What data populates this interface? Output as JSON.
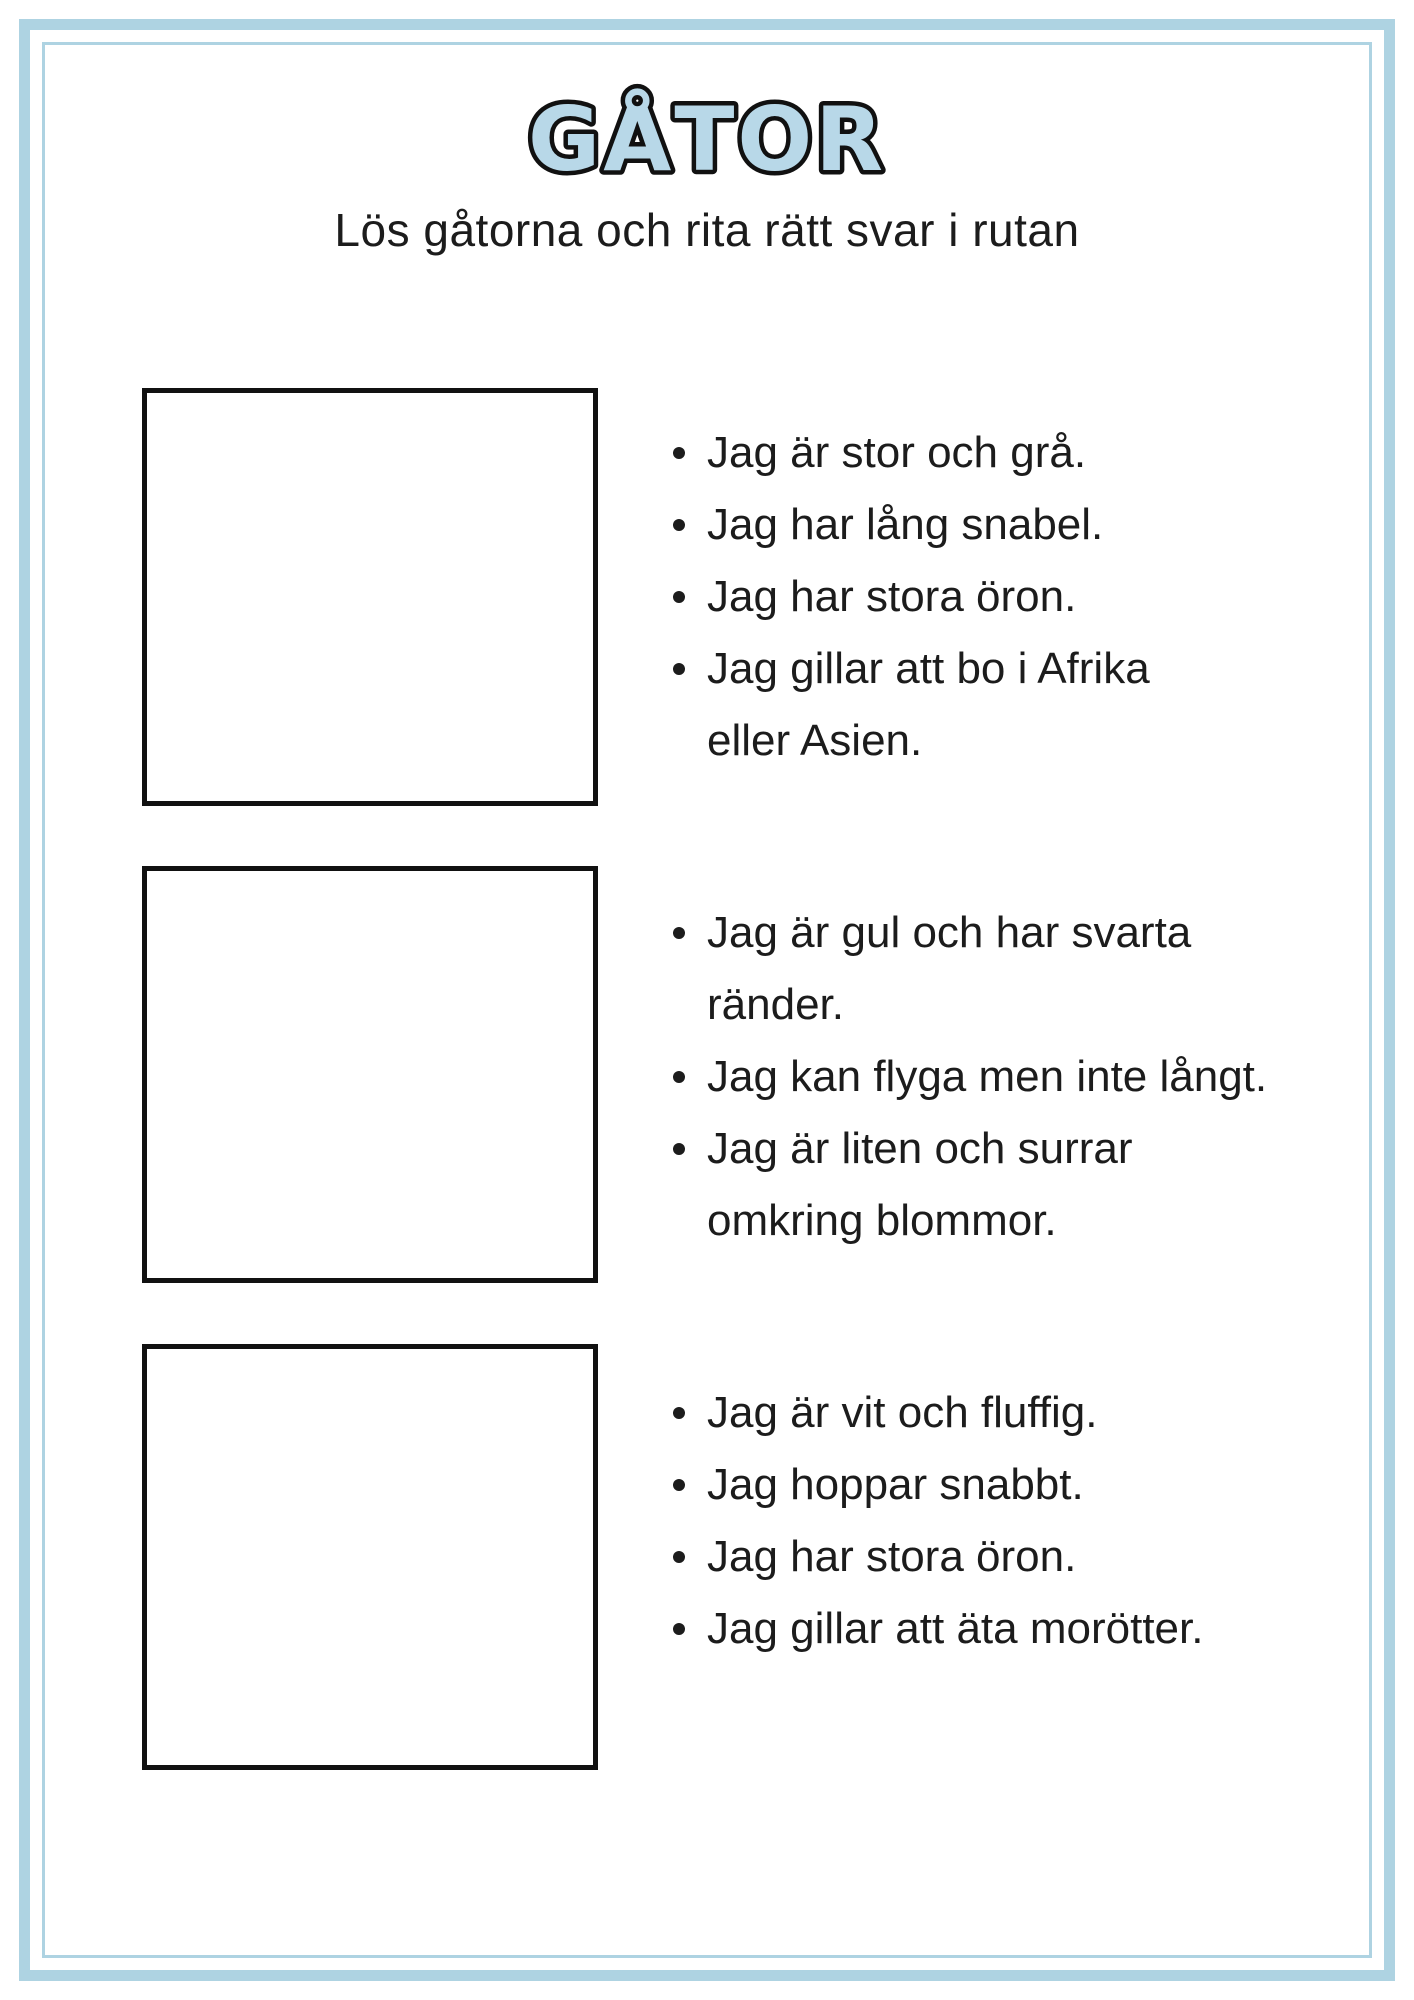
{
  "page": {
    "title": "GÅTOR",
    "subtitle": "Lös gåtorna och rita rätt svar i rutan",
    "colors": {
      "accent_border": "#aed3e2",
      "title_fill": "#b8d8e8",
      "title_outline": "#111111",
      "text": "#1c1c1c",
      "box_border": "#111111"
    },
    "riddles": [
      {
        "lines": [
          {
            "text": "Jag är stor och grå.",
            "bullet": true
          },
          {
            "text": "Jag har lång snabel.",
            "bullet": true
          },
          {
            "text": "Jag har stora öron.",
            "bullet": true
          },
          {
            "text": "Jag gillar att bo i Afrika",
            "bullet": true
          },
          {
            "text": "eller Asien.",
            "bullet": false
          }
        ]
      },
      {
        "lines": [
          {
            "text": "Jag är gul och har svarta",
            "bullet": true
          },
          {
            "text": "ränder.",
            "bullet": false
          },
          {
            "text": "Jag kan flyga men inte långt.",
            "bullet": true
          },
          {
            "text": "Jag är liten och surrar",
            "bullet": true
          },
          {
            "text": "omkring blommor.",
            "bullet": false
          }
        ]
      },
      {
        "lines": [
          {
            "text": "Jag är vit och fluffig.",
            "bullet": true
          },
          {
            "text": "Jag hoppar snabbt.",
            "bullet": true
          },
          {
            "text": "Jag har stora öron.",
            "bullet": true
          },
          {
            "text": "Jag gillar att äta morötter.",
            "bullet": true
          }
        ]
      }
    ]
  }
}
